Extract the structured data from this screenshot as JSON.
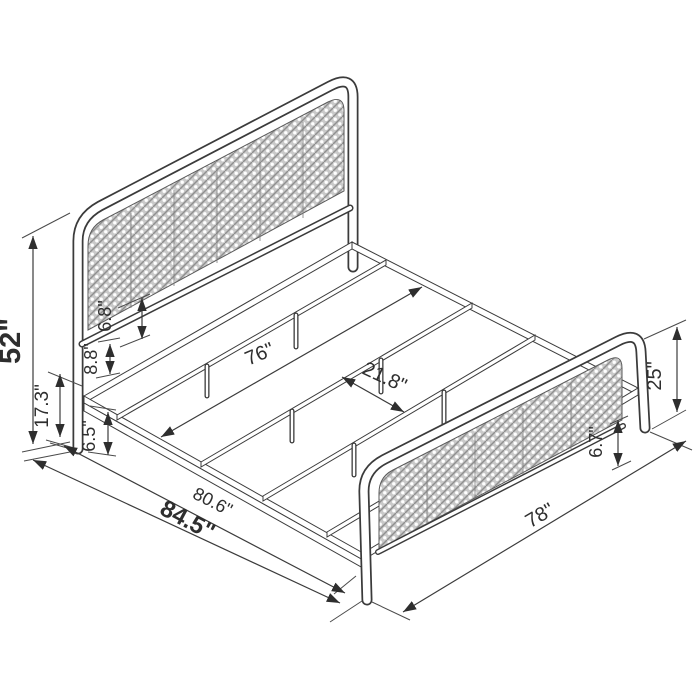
{
  "diagram": {
    "kind": "isometric dimension drawing",
    "product": "metal platform bed frame with woven cane headboard and footboard",
    "units": "inches",
    "colors": {
      "line": "#3b3b3b",
      "panel_fill": "#cdcdcd",
      "panel_hole": "#ffffff",
      "background": "#ffffff"
    },
    "dimensions": {
      "headboard_height": {
        "label": "52\"",
        "emphasis": "bold"
      },
      "underbed_clearance": {
        "label": "17.3\"",
        "emphasis": "normal"
      },
      "panel_to_crossbar_gap": {
        "label": "6.8\"",
        "emphasis": "normal"
      },
      "crossbar_to_rail_gap": {
        "label": "8.8\"",
        "emphasis": "normal"
      },
      "rail_height": {
        "label": "6.5\"",
        "emphasis": "normal"
      },
      "inner_width": {
        "label": "76\"",
        "emphasis": "normal"
      },
      "support_rail_spacing": {
        "label": "21.8\"",
        "emphasis": "normal"
      },
      "frame_length": {
        "label": "80.6\"",
        "emphasis": "normal"
      },
      "overall_length": {
        "label": "84.5\"",
        "emphasis": "bold"
      },
      "overall_width": {
        "label": "78\"",
        "emphasis": "normal"
      },
      "footboard_height": {
        "label": "25\"",
        "emphasis": "normal"
      },
      "footboard_panel_clearance": {
        "label": "6.7\"",
        "emphasis": "normal"
      }
    }
  }
}
